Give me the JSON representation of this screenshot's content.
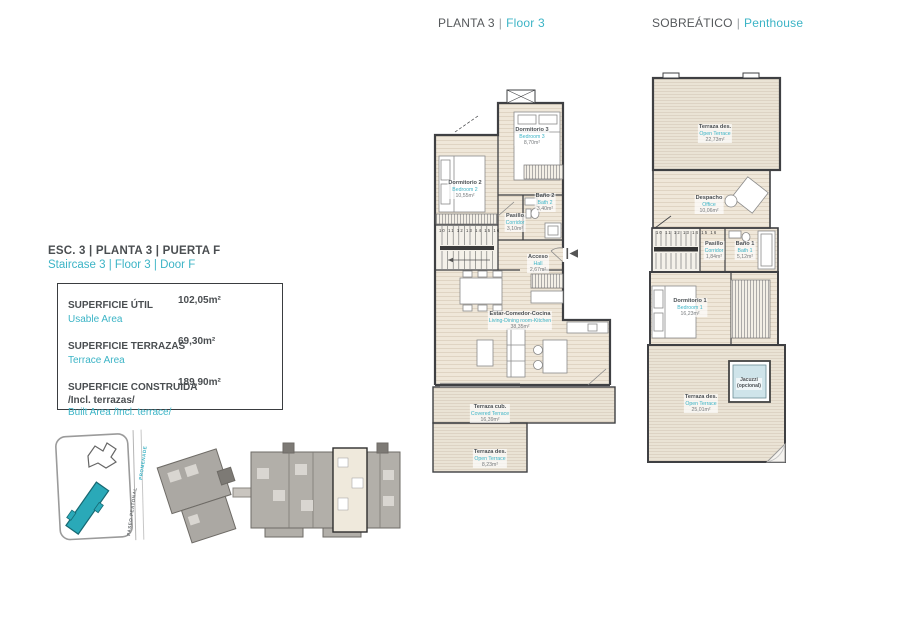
{
  "headers": {
    "left": {
      "primary": "PLANTA 3",
      "divider": "|",
      "secondary": "Floor 3"
    },
    "right": {
      "primary": "SOBREÁTICO",
      "divider": "|",
      "secondary": "Penthouse"
    }
  },
  "unit_info": {
    "title_primary": "ESC. 3 | PLANTA 3 | PUERTA F",
    "title_secondary": "Staircase 3 | Floor 3 | Door F",
    "rows": [
      {
        "label": "SUPERFICIE ÚTIL",
        "value": "102,05m²",
        "sublabel": "",
        "translation": "Usable Area"
      },
      {
        "label": "SUPERFICIE TERRAZAS",
        "value": "69,30m²",
        "sublabel": "",
        "translation": "Terrace Area"
      },
      {
        "label": "SUPERFICIE CONSTRUIDA",
        "value": "189,90m²",
        "sublabel": "/Incl. terrazas/",
        "translation": "Built Area /Incl. terrace/"
      }
    ]
  },
  "floor3_plan": {
    "rooms": {
      "bedroom2": {
        "es": "Dormitorio 2",
        "en": "Bedroom 2",
        "area": "10,55m²"
      },
      "bedroom3": {
        "es": "Dormitorio 3",
        "en": "Bedroom 3",
        "area": "8,70m²"
      },
      "bath2": {
        "es": "Baño 2",
        "en": "Bath 2",
        "area": "3,40m²"
      },
      "corridor": {
        "es": "Pasillo",
        "en": "Corridor",
        "area": "3,10m²"
      },
      "hall": {
        "es": "Acceso",
        "en": "Hall",
        "area": "2,67m²"
      },
      "living": {
        "es": "Estar-Comedor-Cocina",
        "en": "Living-Dining room-Kitchen",
        "area": "38,35m²"
      },
      "covered_terrace": {
        "es": "Terraza cub.",
        "en": "Covered Terrace",
        "area": "16,39m²"
      },
      "open_terrace": {
        "es": "Terraza des.",
        "en": "Open Terrace",
        "area": "8,23m²"
      }
    },
    "stair_numbers": "10  11 12 13 14 15 16"
  },
  "penthouse_plan": {
    "rooms": {
      "top_terrace": {
        "es": "Terraza des.",
        "en": "Open Terrace",
        "area": "22,73m²"
      },
      "office": {
        "es": "Despacho",
        "en": "Office",
        "area": "10,06m²"
      },
      "corridor": {
        "es": "Pasillo",
        "en": "Corridor",
        "area": "1,84m²"
      },
      "bath1": {
        "es": "Baño 1",
        "en": "Bath 1",
        "area": "5,12m²"
      },
      "bedroom1": {
        "es": "Dormitorio 1",
        "en": "Bedroom 1",
        "area": "16,23m²"
      },
      "bottom_terrace": {
        "es": "Terraza des.",
        "en": "Open Terrace",
        "area": "25,01m²"
      }
    },
    "jacuzzi": {
      "line1": "Jacuzzi",
      "line2": "(opcional)"
    },
    "stair_numbers": "10  11 12 13 14 15 16"
  },
  "site_plan": {
    "street_es": "PASEO PEATONAL",
    "street_en": "PROMENADE"
  },
  "colors": {
    "accent": "#3cb4c6",
    "text_dark": "#4a4e51",
    "wall": "#3f4043",
    "floor_fill": "#efe7d9",
    "terrace_fill": "#eae3d5",
    "jacuzzi_fill": "#cfe4ea",
    "site_building": "#2aa9b8",
    "keyplan_gray": "#b2afa9",
    "highlight_unit": "#efe9dc"
  }
}
